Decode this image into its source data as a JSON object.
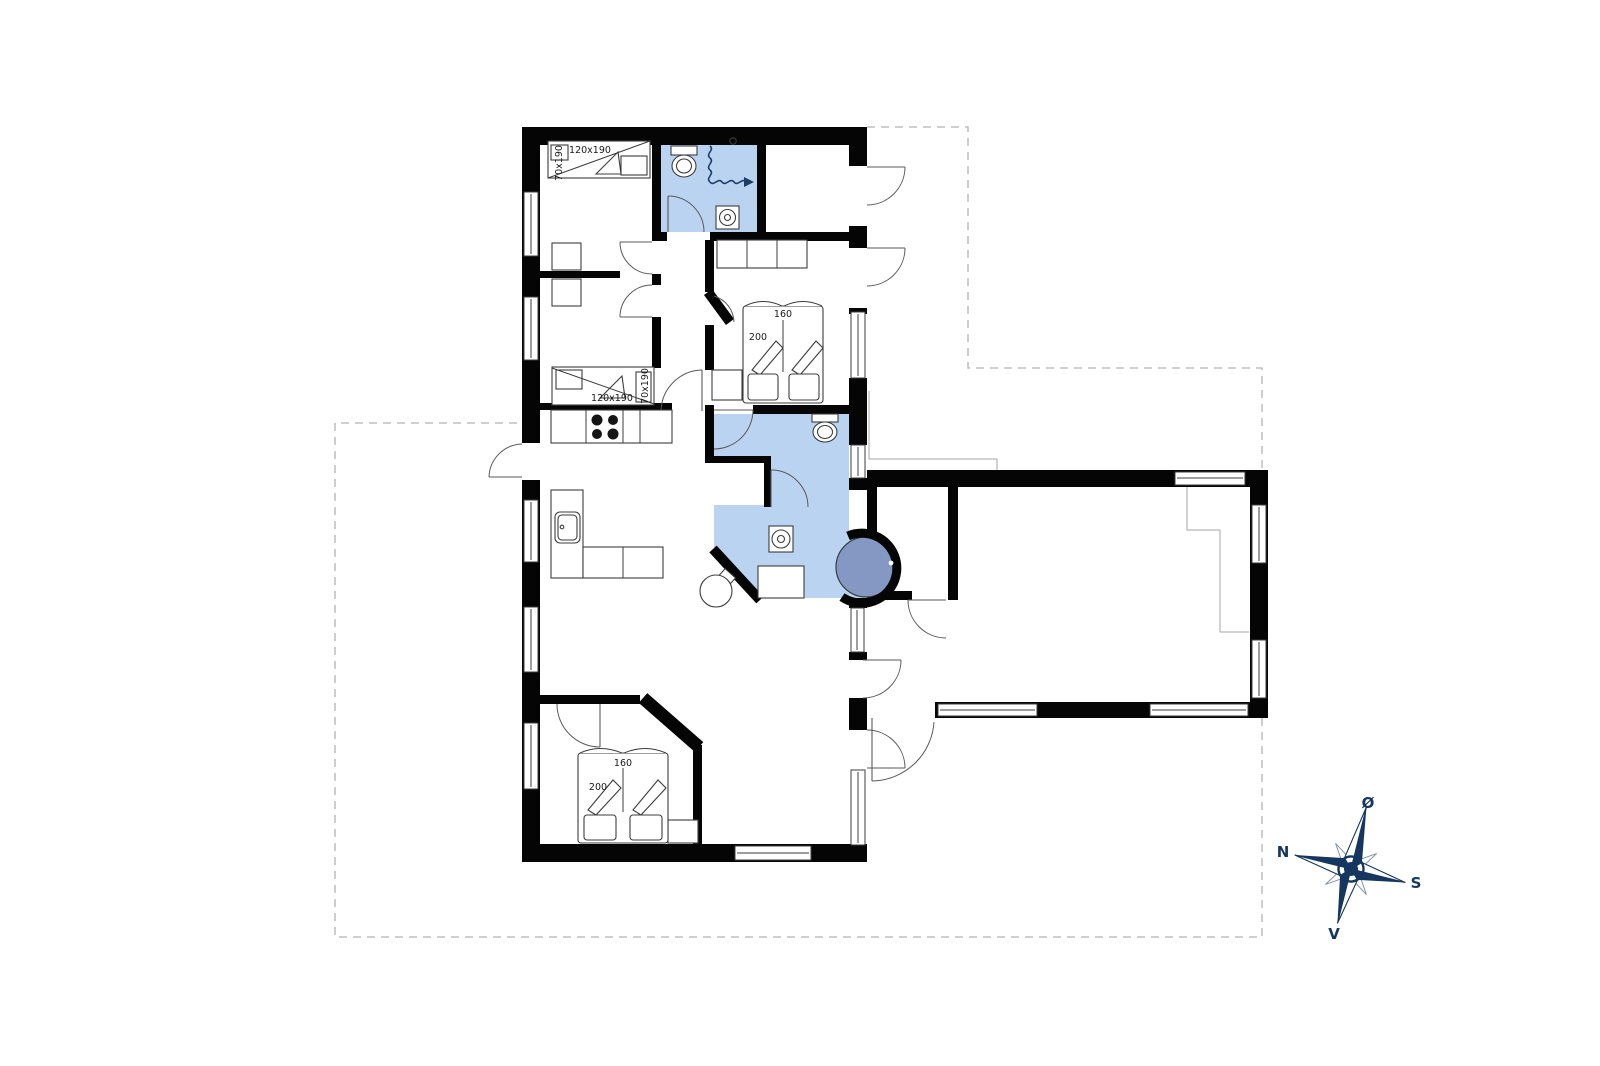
{
  "beds": {
    "bunk_top": {
      "size": "120x190",
      "upper": "70x190"
    },
    "bunk_bottom": {
      "size": "120x190",
      "upper": "70x190"
    },
    "double_north": {
      "width": "160",
      "length": "200"
    },
    "double_south": {
      "width": "160",
      "length": "200"
    }
  },
  "compass": {
    "north": "N",
    "east": "Ø",
    "south": "S",
    "west": "V"
  },
  "colors": {
    "bath": "#b9d3f1",
    "spa": "#8498c3",
    "compass_navy": "#15365f",
    "wall": "#050505",
    "line": "#3c3c3c",
    "loft_line": "#a6a6a6",
    "dash": "#b2b2b2",
    "label": "#1a1a1a"
  }
}
